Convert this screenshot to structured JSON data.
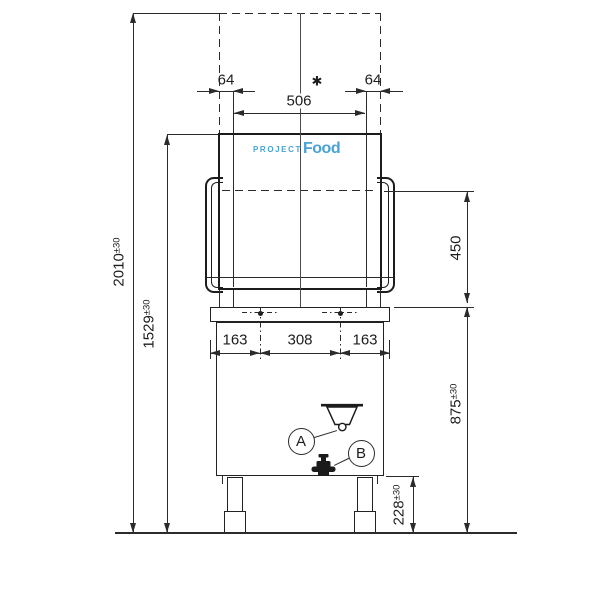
{
  "drawing": {
    "logo": {
      "brand_top": "PROJECT",
      "brand_main": "Food",
      "color": "#47a3d5"
    },
    "callouts": {
      "a": "A",
      "b": "B"
    },
    "dims": {
      "hood_overhang_left": "64",
      "hood_overhang_right": "64",
      "star": "✱",
      "opening_width": "506",
      "side_left": "163",
      "center_width": "308",
      "side_right": "163",
      "total_height": "2010",
      "total_height_tol": "±30",
      "hood_open_height": "1529",
      "hood_open_height_tol": "±30",
      "clearance_height": "450",
      "worktop_height": "875",
      "worktop_height_tol": "±30",
      "drain_height": "228",
      "drain_height_tol": "±30"
    }
  }
}
